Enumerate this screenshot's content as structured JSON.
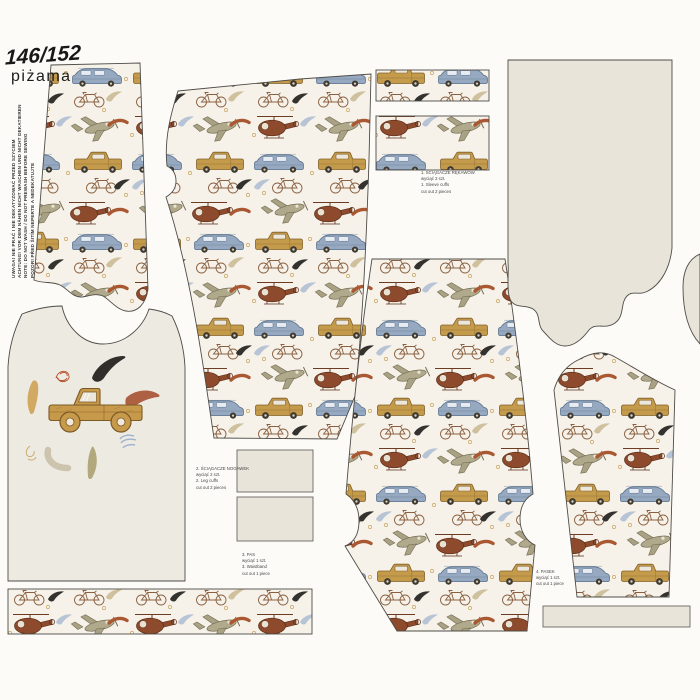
{
  "header": {
    "size_label": "146/152",
    "product_label": "piżama"
  },
  "care_note_vertical": {
    "l1": "UWAGA! NIE PRAĆ I NIE DEKATYZOWAĆ PRZED SZYCIEM",
    "l2": "ACHTUNG! VOR DEM NÄHEN NICHT WASCHEN UND NICHT DEKATIEREN",
    "l3": "NOTE: DO NOT WASH / DO NOT PREWASH BEFORE SEWING",
    "l4": "POZOR! PŘED ŠITÍM NEPERTE A NEDEKATUJTE"
  },
  "captions": {
    "sleeve_cuffs": {
      "l1": "1. ŚCIĄGACZE RĘKAWÓW",
      "l2": "wyciąć 2 szt.",
      "l3": "1. Sleeve cuffs",
      "l4": "cut out 2 pieces"
    },
    "leg_cuffs": {
      "l1": "2. ŚCIĄGACZE NOGAWEK",
      "l2": "wyciąć 2 szt.",
      "l3": "2. Leg cuffs",
      "l4": "cut out 2 pieces"
    },
    "waistband": {
      "l1": "3. PAS",
      "l2": "wyciąć 1 szt.",
      "l3": "3. Waistband",
      "l4": "cut out 1 piece"
    },
    "neckband": {
      "l1": "4. PASEK",
      "l2": "wyciąć 1 szt.",
      "l3": "cut out 1 piece"
    }
  },
  "print_motifs": [
    "pickup-truck",
    "station-wagon-car",
    "helicopter",
    "airplane",
    "bicycle",
    "brush-swoosh",
    "sausage-stroke",
    "dot"
  ],
  "colors": {
    "fabric_background": "#f6f2ea",
    "solid_fabric": "#eae6dd",
    "truck_gold": "#c49a4b",
    "car_blue": "#96a9c0",
    "helicopter_rust": "#8d4a2c",
    "plane_khaki": "#b1a98b",
    "bicycle_brown": "#8a6040",
    "swoosh_black": "#34322e",
    "swoosh_blue": "#b7c4d6",
    "swoosh_tan": "#cfc09e",
    "sausage_rust": "#aa5832",
    "cut_outline": "#4f4c46"
  }
}
